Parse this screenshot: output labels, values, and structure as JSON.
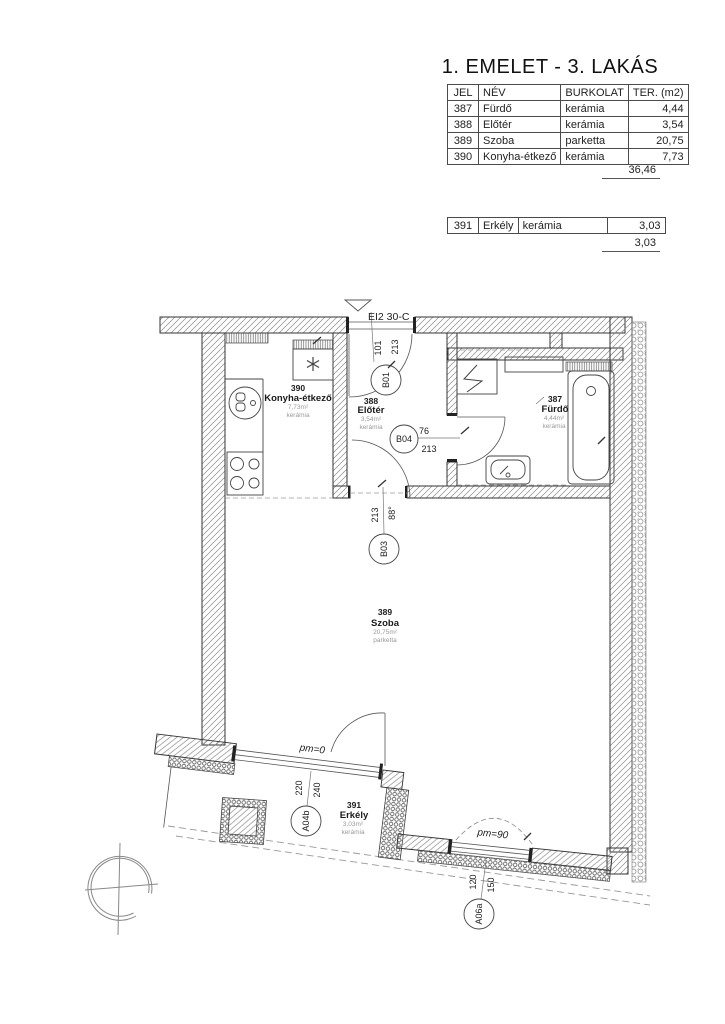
{
  "title": "1. EMELET - 3. LAKÁS",
  "area_table": {
    "headers": {
      "jel": "JEL",
      "nev": "NÉV",
      "burkolat": "BURKOLAT",
      "ter": "TER. (m2)"
    },
    "rows": [
      {
        "jel": "387",
        "nev": "Fürdő",
        "burkolat": "kerámia",
        "ter": "4,44"
      },
      {
        "jel": "388",
        "nev": "Előtér",
        "burkolat": "kerámia",
        "ter": "3,54"
      },
      {
        "jel": "389",
        "nev": "Szoba",
        "burkolat": "parketta",
        "ter": "20,75"
      },
      {
        "jel": "390",
        "nev": "Konyha-étkező",
        "burkolat": "kerámia",
        "ter": "7,73"
      }
    ],
    "total": "36,46"
  },
  "balcony_table": {
    "row": {
      "jel": "391",
      "nev": "Erkély",
      "burkolat": "kerámia",
      "ter": "3,03"
    },
    "total": "3,03"
  },
  "plan": {
    "entrance_label": "EI2 30-C",
    "rooms": {
      "konyha": {
        "num": "390",
        "name": "Konyha-étkező",
        "area": "7,73m²",
        "floor": "kerámia"
      },
      "eloter": {
        "num": "388",
        "name": "Előtér",
        "area": "3,54m²",
        "floor": "kerámia"
      },
      "furdo": {
        "num": "387",
        "name": "Fürdő",
        "area": "4,44m²",
        "floor": "kerámia"
      },
      "szoba": {
        "num": "389",
        "name": "Szoba",
        "area": "20,75m²",
        "floor": "parketta"
      },
      "erkely": {
        "num": "391",
        "name": "Erkély",
        "area": "3,03m²",
        "floor": "kerámia"
      }
    },
    "doors": {
      "b01": {
        "id": "B01",
        "dim1": "101",
        "dim2": "213"
      },
      "b03": {
        "id": "B03",
        "dim1": "213",
        "dim2": "88°"
      },
      "b04": {
        "id": "B04",
        "dim1": "76",
        "dim2": "213"
      },
      "a04b": {
        "id": "A04b",
        "dim1": "220",
        "dim2": "240",
        "parapet": "pm=0"
      },
      "a06a": {
        "id": "A06a",
        "dim1": "120",
        "dim2": "150",
        "parapet": "pm=90"
      }
    },
    "colors": {
      "line": "#333333",
      "hatch": "#8b8b8b",
      "muted_text": "#999999"
    }
  }
}
